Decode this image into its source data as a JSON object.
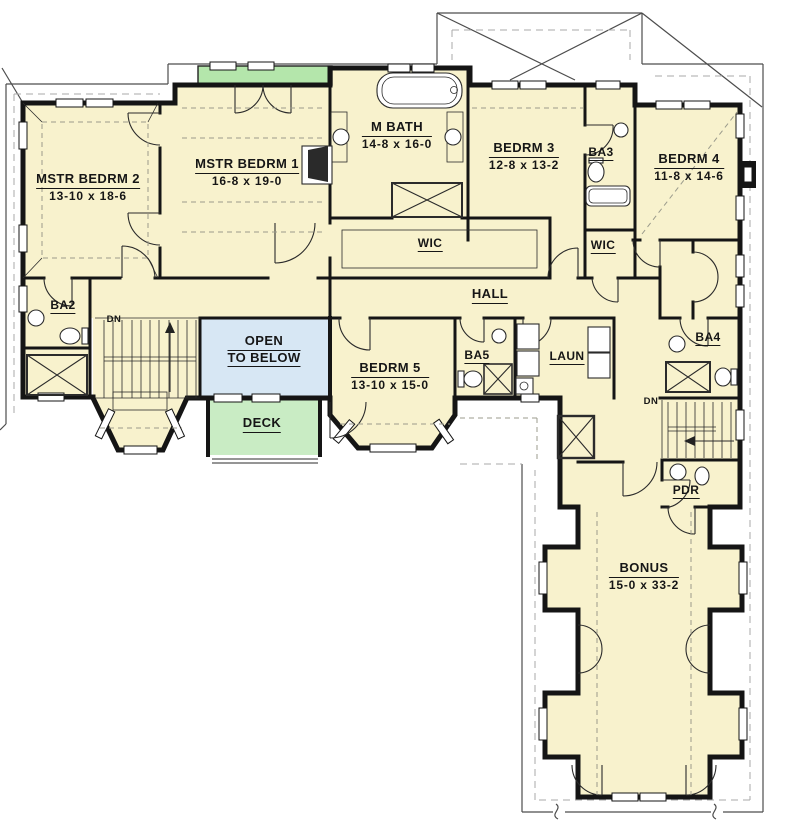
{
  "rooms": {
    "mstr_bedrm_2": {
      "name": "MSTR BEDRM 2",
      "dims": "13-10 x 18-6"
    },
    "mstr_bedrm_1": {
      "name": "MSTR BEDRM 1",
      "dims": "16-8 x 19-0"
    },
    "m_bath": {
      "name": "M BATH",
      "dims": "14-8 x 16-0"
    },
    "bedrm_3": {
      "name": "BEDRM 3",
      "dims": "12-8 x 13-2"
    },
    "ba3": {
      "name": "BA3"
    },
    "bedrm_4": {
      "name": "BEDRM 4",
      "dims": "11-8 x 14-6"
    },
    "wic_master": {
      "name": "WIC"
    },
    "wic_bedrm3": {
      "name": "WIC"
    },
    "hall": {
      "name": "HALL"
    },
    "ba2": {
      "name": "BA2"
    },
    "open_to_below": {
      "line1": "OPEN",
      "line2": "TO BELOW"
    },
    "bedrm_5": {
      "name": "BEDRM 5",
      "dims": "13-10 x 15-0"
    },
    "ba5": {
      "name": "BA5"
    },
    "laun": {
      "name": "LAUN"
    },
    "ba4": {
      "name": "BA4"
    },
    "deck": {
      "name": "DECK"
    },
    "pdr": {
      "name": "PDR"
    },
    "bonus": {
      "name": "BONUS",
      "dims": "15-0 x 33-2"
    },
    "dn_left": {
      "name": "DN"
    },
    "dn_right": {
      "name": "DN"
    }
  },
  "colors": {
    "floor": "#f8f2cd",
    "open": "#d7e7f4",
    "deck": "#c9ecc4",
    "balcony": "#b4e6ab",
    "wall": "#151515",
    "line": "#2b2b2b",
    "roof": "#4d4d4d",
    "dash": "#9b9b8c"
  }
}
